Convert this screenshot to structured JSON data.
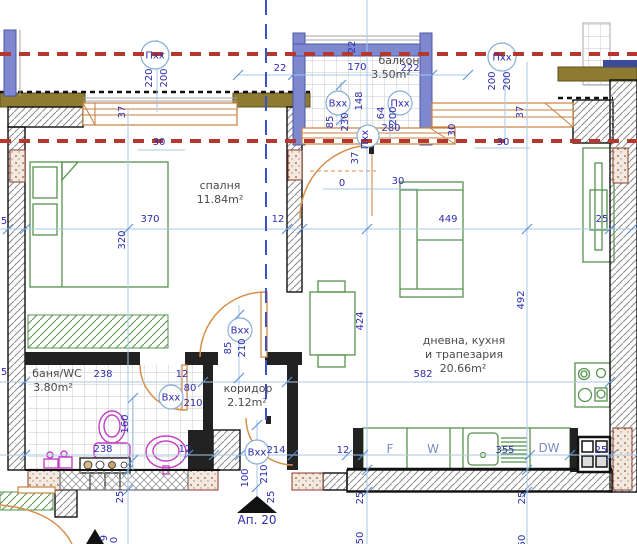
{
  "plan": {
    "apartment": {
      "label": "Ап. 20"
    },
    "colors": {
      "axis_red": "#b4382e",
      "section_blue": "#3d52c5",
      "dim_blue": "#2d2db0",
      "dim_line": "#a9c7e5",
      "furniture_green": "#56934d",
      "sanitary_magenta": "#c43fc4",
      "door_orange": "#d98e4a",
      "facade_olive": "#8d7b31",
      "window_blue": "#7d88cf",
      "wall_black": "#1c1c1c"
    }
  },
  "texts": {
    "rooms": [
      {
        "t": "спалня",
        "x": 220,
        "y": 189
      },
      {
        "t": "11.84m²",
        "x": 220,
        "y": 203
      },
      {
        "t": "баня/WC",
        "x": 57,
        "y": 377
      },
      {
        "t": "3.80m²",
        "x": 53,
        "y": 391
      },
      {
        "t": "коридор",
        "x": 248,
        "y": 392
      },
      {
        "t": "2.12m²",
        "x": 247,
        "y": 406
      },
      {
        "t": "дневна, кухня",
        "x": 464,
        "y": 344
      },
      {
        "t": "и трапезария",
        "x": 464,
        "y": 358
      },
      {
        "t": "20.66m²",
        "x": 463,
        "y": 372
      },
      {
        "t": "балкон",
        "x": 399,
        "y": 64
      },
      {
        "t": "3.50m²",
        "x": 391,
        "y": 78
      }
    ],
    "dims": [
      {
        "t": "220",
        "x": 152,
        "y": 78,
        "r": 1
      },
      {
        "t": "200",
        "x": 167,
        "y": 78,
        "r": 1
      },
      {
        "t": "37",
        "x": 125,
        "y": 112,
        "r": 1
      },
      {
        "t": "30",
        "x": 159,
        "y": 145,
        "r": 0
      },
      {
        "t": "22",
        "x": 280,
        "y": 71,
        "r": 0
      },
      {
        "t": "22",
        "x": 355,
        "y": 47,
        "r": 1
      },
      {
        "t": "170",
        "x": 357,
        "y": 70,
        "r": 0
      },
      {
        "t": "222",
        "x": 410,
        "y": 71,
        "r": 0
      },
      {
        "t": "148",
        "x": 362,
        "y": 101,
        "r": 1
      },
      {
        "t": "85",
        "x": 333,
        "y": 122,
        "r": 1
      },
      {
        "t": "230",
        "x": 348,
        "y": 122,
        "r": 1
      },
      {
        "t": "64",
        "x": 384,
        "y": 113,
        "r": 1
      },
      {
        "t": "200",
        "x": 396,
        "y": 116,
        "r": 1
      },
      {
        "t": "280",
        "x": 391,
        "y": 131,
        "r": 0
      },
      {
        "t": "200",
        "x": 495,
        "y": 81,
        "r": 1
      },
      {
        "t": "200",
        "x": 510,
        "y": 81,
        "r": 1
      },
      {
        "t": "37",
        "x": 523,
        "y": 112,
        "r": 1
      },
      {
        "t": "30",
        "x": 455,
        "y": 130,
        "r": 1
      },
      {
        "t": "30",
        "x": 503,
        "y": 145,
        "r": 0
      },
      {
        "t": "0",
        "x": 342,
        "y": 186,
        "r": 0
      },
      {
        "t": "30",
        "x": 398,
        "y": 184,
        "r": 0
      },
      {
        "t": "37",
        "x": 358,
        "y": 158,
        "r": 1
      },
      {
        "t": "370",
        "x": 150,
        "y": 222,
        "r": 0
      },
      {
        "t": "12",
        "x": 278,
        "y": 222,
        "r": 0
      },
      {
        "t": "449",
        "x": 448,
        "y": 222,
        "r": 0
      },
      {
        "t": "25",
        "x": 602,
        "y": 222,
        "r": 0
      },
      {
        "t": "5",
        "x": 4,
        "y": 224,
        "r": 0
      },
      {
        "t": "320",
        "x": 125,
        "y": 240,
        "r": 1
      },
      {
        "t": "424",
        "x": 363,
        "y": 321,
        "r": 1
      },
      {
        "t": "492",
        "x": 524,
        "y": 300,
        "r": 1
      },
      {
        "t": "85",
        "x": 231,
        "y": 348,
        "r": 1
      },
      {
        "t": "210",
        "x": 245,
        "y": 348,
        "r": 1
      },
      {
        "t": "238",
        "x": 103,
        "y": 377,
        "r": 0
      },
      {
        "t": "12",
        "x": 182,
        "y": 377,
        "r": 0
      },
      {
        "t": "80",
        "x": 190,
        "y": 391,
        "r": 0
      },
      {
        "t": "210",
        "x": 193,
        "y": 406,
        "r": 0
      },
      {
        "t": "5",
        "x": 4,
        "y": 375,
        "r": 0
      },
      {
        "t": "582",
        "x": 423,
        "y": 377,
        "r": 0
      },
      {
        "t": "160",
        "x": 128,
        "y": 424,
        "r": 1
      },
      {
        "t": "238",
        "x": 103,
        "y": 452,
        "r": 0
      },
      {
        "t": "12",
        "x": 185,
        "y": 452,
        "r": 0
      },
      {
        "t": "214",
        "x": 276,
        "y": 453,
        "r": 0
      },
      {
        "t": "12",
        "x": 343,
        "y": 453,
        "r": 0
      },
      {
        "t": "355",
        "x": 505,
        "y": 453,
        "r": 0
      },
      {
        "t": "25",
        "x": 601,
        "y": 453,
        "r": 0
      },
      {
        "t": "100",
        "x": 248,
        "y": 478,
        "r": 1
      },
      {
        "t": "210",
        "x": 267,
        "y": 474,
        "r": 1
      },
      {
        "t": "25",
        "x": 123,
        "y": 497,
        "r": 1
      },
      {
        "t": "25",
        "x": 274,
        "y": 497,
        "r": 1
      },
      {
        "t": "25",
        "x": 363,
        "y": 498,
        "r": 1
      },
      {
        "t": "25",
        "x": 525,
        "y": 498,
        "r": 1
      },
      {
        "t": "50",
        "x": 363,
        "y": 538,
        "r": 1
      },
      {
        "t": "50",
        "x": 525,
        "y": 541,
        "r": 1
      },
      {
        "t": "9",
        "x": 107,
        "y": 538,
        "r": 1
      },
      {
        "t": "0",
        "x": 117,
        "y": 540,
        "r": 1
      }
    ],
    "kitchen": [
      {
        "t": "F",
        "x": 390,
        "y": 453
      },
      {
        "t": "W",
        "x": 433,
        "y": 453
      },
      {
        "t": "DW",
        "x": 549,
        "y": 452
      }
    ],
    "markers": [
      {
        "t": "Пхх",
        "x": 155,
        "y": 55,
        "rad": 14,
        "r": 0
      },
      {
        "t": "Пхх",
        "x": 502,
        "y": 57,
        "rad": 14,
        "r": 0
      },
      {
        "t": "Вхх",
        "x": 338,
        "y": 103,
        "rad": 12,
        "r": 0
      },
      {
        "t": "Пхх",
        "x": 400,
        "y": 103,
        "rad": 12,
        "r": 0
      },
      {
        "t": "Пхх",
        "x": 368,
        "y": 136,
        "rad": 11,
        "r": 1
      },
      {
        "t": "Вхх",
        "x": 240,
        "y": 330,
        "rad": 12,
        "r": 0
      },
      {
        "t": "Вхх",
        "x": 171,
        "y": 397,
        "rad": 12,
        "r": 0
      },
      {
        "t": "Вхх",
        "x": 257,
        "y": 452,
        "rad": 12,
        "r": 0
      }
    ],
    "apt": {
      "t": "Ап. 20",
      "x": 257,
      "y": 524
    }
  }
}
